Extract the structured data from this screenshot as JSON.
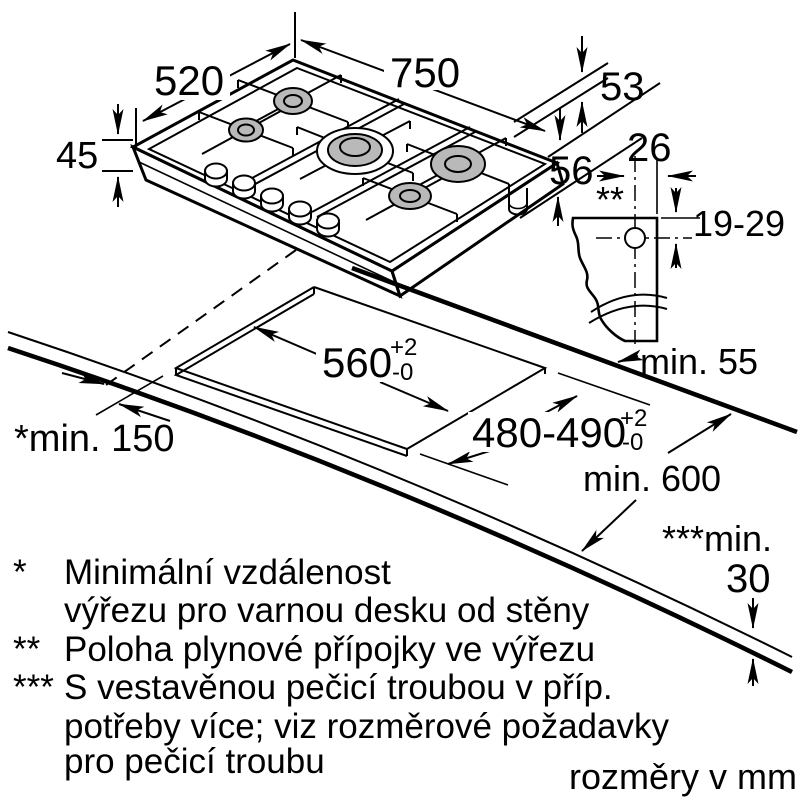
{
  "colors": {
    "line": "#000000",
    "burner_fill": "#b9b9b9"
  },
  "hob_dims": {
    "width": "750",
    "depth": "520",
    "height": "45",
    "edge_gap": "53",
    "connector_gap": "56"
  },
  "gas_detail": {
    "note_marker": "**",
    "offset": "26",
    "depth_range": "19-29"
  },
  "cutout": {
    "width": "560",
    "width_tol_plus": "+2",
    "width_tol_minus": "-0",
    "depth": "480-490",
    "depth_tol_plus": "+2",
    "depth_tol_minus": "-0",
    "wall_clearance": "min. 55",
    "side_clearance": "*min. 150",
    "worktop_depth": "min. 600",
    "worktop_thickness_label": "***min.",
    "worktop_thickness_value": "30"
  },
  "legend": {
    "m1": "*",
    "l1a": "Minimální vzdálenost",
    "l1b": "výřezu pro varnou desku od stěny",
    "m2": "**",
    "l2a": "Poloha plynové přípojky ve výřezu",
    "m3": "***",
    "l3a": "S vestavěnou pečicí troubou v příp.",
    "l3b": "potřeby více; viz rozměrové požadavky",
    "l3c": "pro pečicí troubu"
  },
  "footer": {
    "units": "rozměry v mm"
  }
}
